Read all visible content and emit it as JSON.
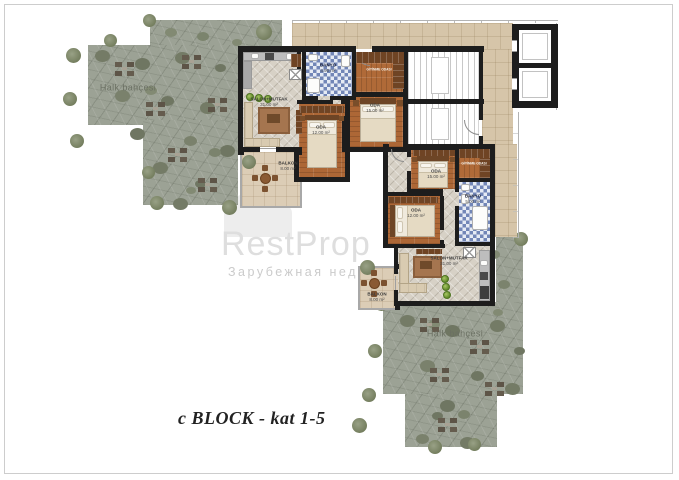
{
  "page": {
    "title_label": "c BLOCK - kat 1-5"
  },
  "watermark": {
    "brand": "RestProp",
    "subtitle": "Зарубежная недвижимость"
  },
  "gardens": {
    "top_left": {
      "label": "Halk bahçesi"
    },
    "bottom_right": {
      "label": "Halk bahçesi"
    }
  },
  "apartments": {
    "upper": {
      "salon": {
        "name": "SALON+MUTFAK",
        "area": "31.00 m²"
      },
      "oda_12": {
        "name": "ODA",
        "area": "12.00 m²"
      },
      "oda_15": {
        "name": "ODA",
        "area": "15.00 m²"
      },
      "banyo": {
        "name": "BANYO",
        "area": "4.90 m²"
      },
      "balkon": {
        "name": "BALKON",
        "area": "8.00 m²"
      },
      "giyinme": {
        "name": "GİYİNME ODASI"
      }
    },
    "lower": {
      "salon": {
        "name": "SALON+MUTFAK",
        "area": "31.00 m²"
      },
      "oda_12": {
        "name": "ODA",
        "area": "12.00 m²"
      },
      "oda_15": {
        "name": "ODA",
        "area": "15.00 m²"
      },
      "banyo": {
        "name": "BANYO",
        "area": "5.00 m²"
      },
      "balkon": {
        "name": "BALKON",
        "area": "8.00 m²"
      },
      "giyinme": {
        "name": "GİYİNME ODASI"
      }
    }
  }
}
